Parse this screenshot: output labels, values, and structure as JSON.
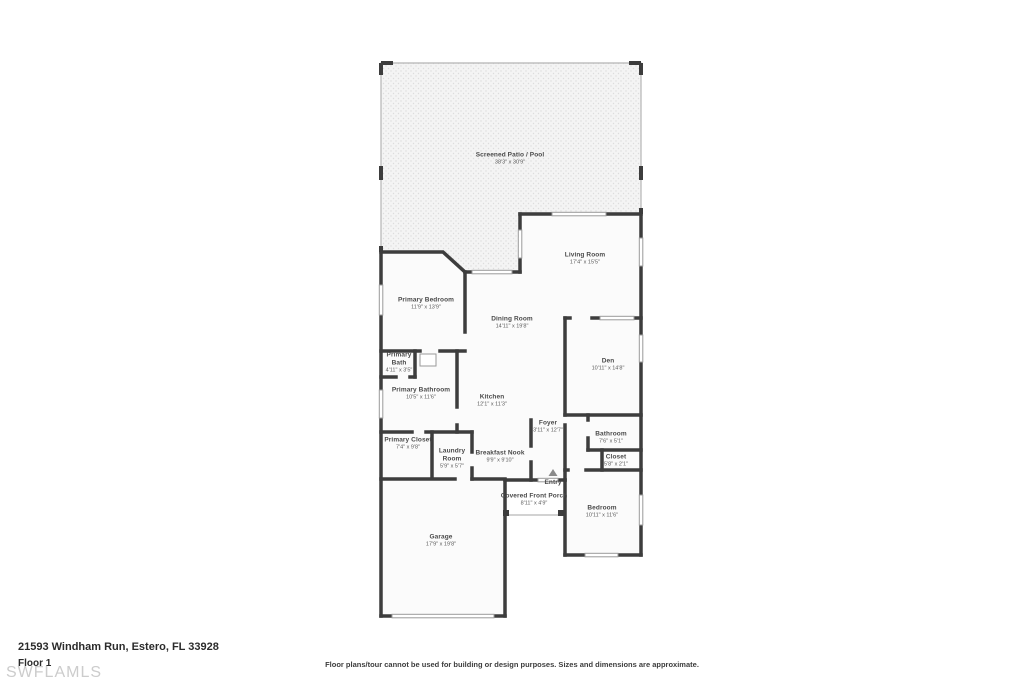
{
  "floorplan": {
    "address": "21593 Windham Run, Estero, FL 33928",
    "floor_label": "Floor 1",
    "watermark": "SWFLAMLS",
    "disclaimer": "Floor plans/tour cannot be used for building or design purposes. Sizes and dimensions are approximate.",
    "rooms": [
      {
        "name": "Screened Patio / Pool",
        "dims": "38'3\" x 30'9\""
      },
      {
        "name": "Living Room",
        "dims": "17'4\" x 15'5\""
      },
      {
        "name": "Primary Bedroom",
        "dims": "11'9\" x 13'9\""
      },
      {
        "name": "Dining Room",
        "dims": "14'11\" x 19'8\""
      },
      {
        "name": "Den",
        "dims": "10'11\" x 14'8\""
      },
      {
        "name": "Primary Bath",
        "dims": "4'11\" x 3'5\""
      },
      {
        "name": "Primary Bathroom",
        "dims": "10'5\" x 11'6\""
      },
      {
        "name": "Kitchen",
        "dims": "12'1\" x 11'3\""
      },
      {
        "name": "Foyer",
        "dims": "3'11\" x 12'7\""
      },
      {
        "name": "Bathroom",
        "dims": "7'6\" x 5'1\""
      },
      {
        "name": "Closet",
        "dims": "5'8\" x 2'1\""
      },
      {
        "name": "Primary Closet",
        "dims": "7'4\" x 9'8\""
      },
      {
        "name": "Laundry Room",
        "dims": "5'9\" x 5'7\""
      },
      {
        "name": "Breakfast Nook",
        "dims": "9'9\" x 9'10\""
      },
      {
        "name": "Entry",
        "dims": ""
      },
      {
        "name": "Covered Front Porch",
        "dims": "8'11\" x 4'9\""
      },
      {
        "name": "Bedroom",
        "dims": "10'11\" x 11'6\""
      },
      {
        "name": "Garage",
        "dims": "17'9\" x 19'8\""
      }
    ]
  }
}
